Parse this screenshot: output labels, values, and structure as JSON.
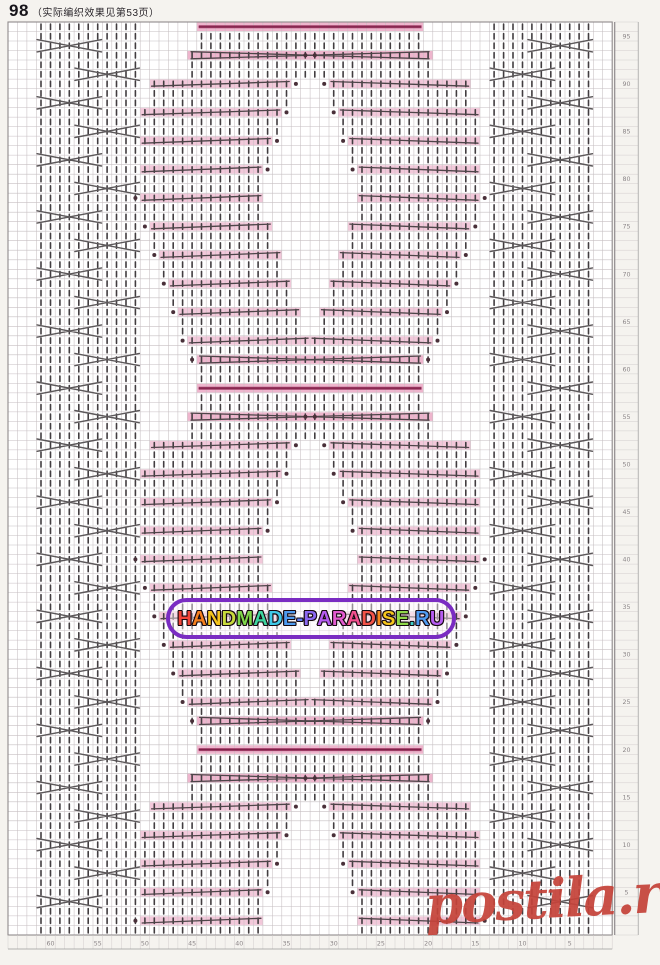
{
  "page": {
    "header_number": "98",
    "header_note": "（实际编织效果见第53页）"
  },
  "watermark_center": {
    "text": "HANDMADE-PARADISE.RU",
    "border_color": "#7a2cc2",
    "letter_colors": [
      "#f2453a",
      "#f57f1e",
      "#f5c51d",
      "#c8d93c",
      "#7fd84a",
      "#3fd6a0",
      "#3fc9e8",
      "#4f9bf0",
      "#5f7df2",
      "#8b68f0",
      "#b55cf0",
      "#e35ad0",
      "#f2508e",
      "#f25349",
      "#f5871e",
      "#f5c51d",
      "#8fd84a",
      "#3fd0c8",
      "#4f9bf0",
      "#b55cf0"
    ]
  },
  "watermark_corner": {
    "text": "postila.ru",
    "color": "#c5433a"
  },
  "chart_data": {
    "type": "knitting-chart",
    "title": "Pattern 98 stitch chart",
    "grid": {
      "cols": 64,
      "rows": 96,
      "x": 8,
      "y": 22,
      "cell_w": 9.44,
      "cell_h": 9.51
    },
    "colors": {
      "grid_bg": "#ffffff",
      "grid_line": "#c6bfc2",
      "grid_strong": "#8f8a8c",
      "symbol": "#423d40",
      "cable": "#5c585a",
      "slant": "#4e4549",
      "bar_fill": "#f2c8da",
      "bar_fill_strong": "#eeb5cd",
      "heavy": "#a23f69",
      "heavy_core": "#7e2148",
      "dot": "#493039",
      "scale_text": "#8c8688",
      "scale_line": "#cfc9cb"
    },
    "left_panel": {
      "cols": [
        3,
        13
      ],
      "cross_order": [
        [
          3,
          9
        ],
        [
          7,
          13
        ]
      ],
      "cross_start_row": 2,
      "cross_step": 3
    },
    "right_panel": {
      "cols": [
        51,
        61
      ],
      "cross_order": [
        [
          55,
          61
        ],
        [
          51,
          57
        ]
      ],
      "cross_start_row": 2,
      "cross_step": 3
    },
    "motif": {
      "mirror_axis": 63,
      "center_span": [
        20,
        43
      ],
      "heavy_rows": [
        0,
        38,
        76
      ],
      "phases": [
        {
          "o": 3,
          "s": 19,
          "e": 31,
          "dot": "center",
          "meet": true
        },
        {
          "o": 6,
          "s": 15,
          "e": 29,
          "dot": "inner"
        },
        {
          "o": 9,
          "s": 14,
          "e": 28,
          "dot": "inner"
        },
        {
          "o": 12,
          "s": 14,
          "e": 27,
          "dot": "inner"
        },
        {
          "o": 15,
          "s": 14,
          "e": 26,
          "dot": "inner"
        },
        {
          "o": 18,
          "s": 14,
          "e": 26,
          "dot": "outer"
        },
        {
          "o": 21,
          "s": 15,
          "e": 27,
          "dot": "outer"
        },
        {
          "o": 24,
          "s": 16,
          "e": 28,
          "dot": "outer"
        },
        {
          "o": 27,
          "s": 17,
          "e": 29,
          "dot": "outer"
        },
        {
          "o": 30,
          "s": 18,
          "e": 30,
          "dot": "outer"
        },
        {
          "o": 33,
          "s": 19,
          "e": 31,
          "dot": "outer"
        },
        {
          "o": 35,
          "s": 20,
          "e": 31,
          "dot": "outer",
          "conv": true
        }
      ]
    },
    "row_numbers": [
      95,
      90,
      85,
      80,
      75,
      70,
      65,
      60,
      55,
      50,
      45,
      40,
      35,
      30,
      25,
      20,
      15,
      10,
      5
    ],
    "bottom_numbers": [
      60,
      55,
      50,
      45,
      40,
      35,
      30,
      25,
      20,
      15,
      10,
      5
    ]
  }
}
